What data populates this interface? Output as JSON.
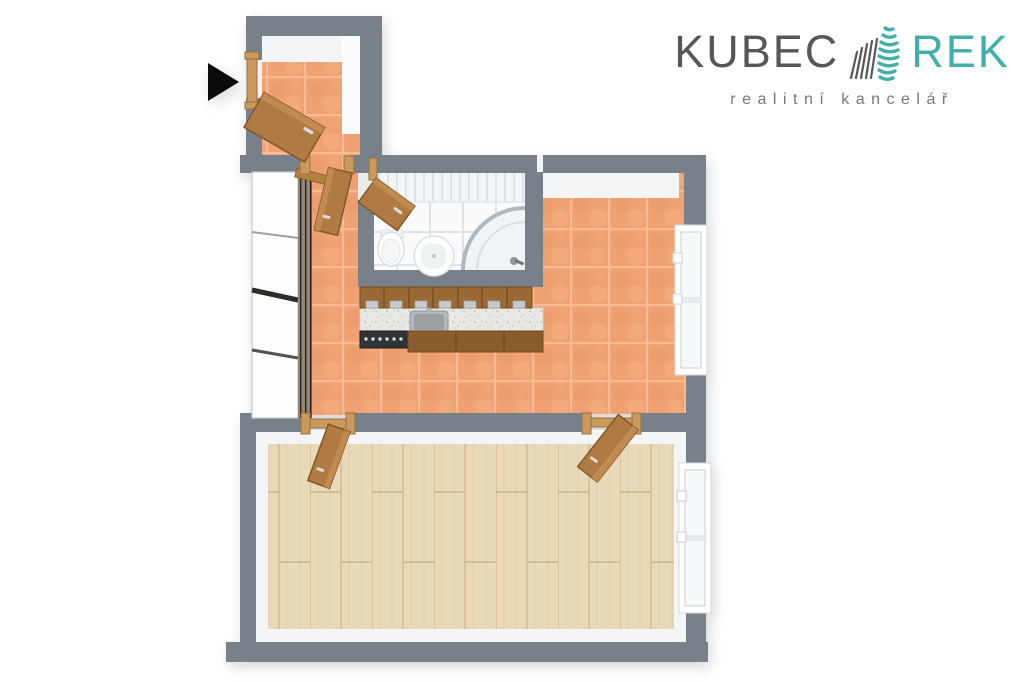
{
  "page": {
    "background": "#ffffff"
  },
  "logo": {
    "brand_primary": "KUBEC",
    "brand_secondary": "REK",
    "tagline": "realitní kancelář",
    "primary_color": "#55575a",
    "accent_color": "#41afaa",
    "tagline_color": "#75777b",
    "icon": "striped-building-logo-icon"
  },
  "floorplan": {
    "type": "3d-top-down-floor-plan",
    "entrance_marker": "black-right-arrow",
    "colors": {
      "walls": "#78808a",
      "terracotta_tile_floor": "#efa173",
      "tile_grout": "#f7bb93",
      "wood_floor": "#e8dab9",
      "bathroom_floor": "#f8fafb",
      "door_wood": "#b07b43",
      "door_frame_wood": "#c9995e",
      "kitchen_cabinets": "#9a6936",
      "countertop": "#e9e9e3",
      "inner_wall_face": "#f4f5f7"
    },
    "rooms": [
      {
        "name": "entry-hall",
        "floor": "terracotta-tile"
      },
      {
        "name": "hallway",
        "floor": "terracotta-tile"
      },
      {
        "name": "kitchen",
        "floor": "terracotta-tile"
      },
      {
        "name": "bathroom",
        "floor": "white-tile"
      },
      {
        "name": "living-room",
        "floor": "wood-planks"
      }
    ],
    "fixtures": [
      "entrance-door",
      "wardrobe-closets",
      "hall-door",
      "bathroom-door",
      "toilet",
      "round-washbasin",
      "corner-shower",
      "kitchen-upper-cabinets",
      "kitchen-countertop",
      "kitchen-sink",
      "stove",
      "kitchen-window",
      "living-room-window",
      "living-room-door-left",
      "living-room-door-right"
    ]
  }
}
